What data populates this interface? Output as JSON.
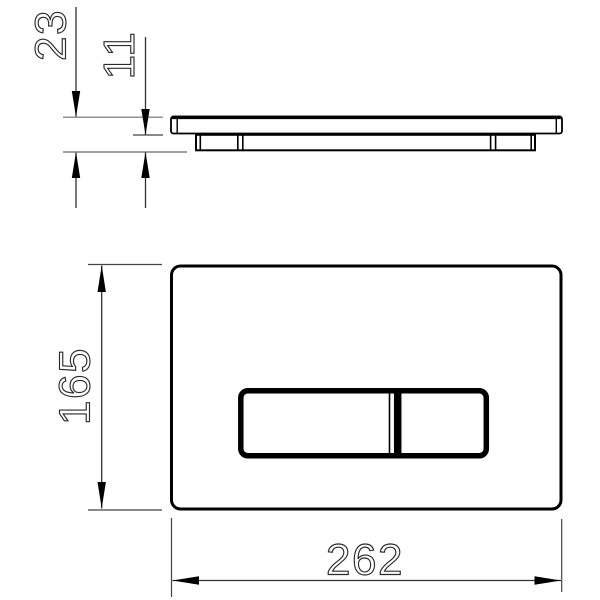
{
  "drawing": {
    "title": "Flush plate technical drawing",
    "side_view": {
      "total_thickness_label": "23",
      "plate_thickness_label": "11"
    },
    "front_view": {
      "height_label": "165",
      "width_label": "262"
    },
    "colors": {
      "outline": "#000000",
      "dimension_line": "#333333",
      "extension_line_gray": "#808080",
      "background": "#ffffff",
      "text_stroke": "#2b2b2b"
    }
  }
}
